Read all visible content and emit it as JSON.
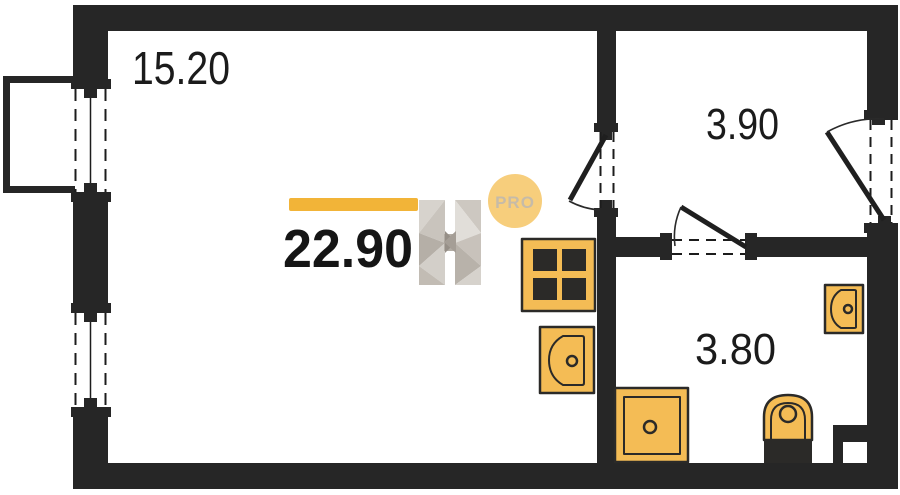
{
  "floor_plan": {
    "total_area": "22.90",
    "badge_label": "PRO",
    "rooms": [
      {
        "id": "living-room",
        "area_label": "15.20"
      },
      {
        "id": "hallway",
        "area_label": "3.90"
      },
      {
        "id": "bathroom",
        "area_label": "3.80"
      }
    ],
    "fixtures": [
      {
        "icon": "stove-icon"
      },
      {
        "icon": "kitchen-sink-icon"
      },
      {
        "icon": "shower-icon"
      },
      {
        "icon": "toilet-icon"
      },
      {
        "icon": "washbasin-icon"
      }
    ],
    "colors": {
      "wall": "#262626",
      "fixture_fill": "#f4bc55",
      "fixture_stroke": "#2b2a28",
      "accent_bar": "#f2b438",
      "badge_bg": "#f7ce7c",
      "badge_text": "#c6bba8",
      "logo_gray_light": "#e1ded9",
      "logo_gray_dark": "#968f87"
    }
  }
}
